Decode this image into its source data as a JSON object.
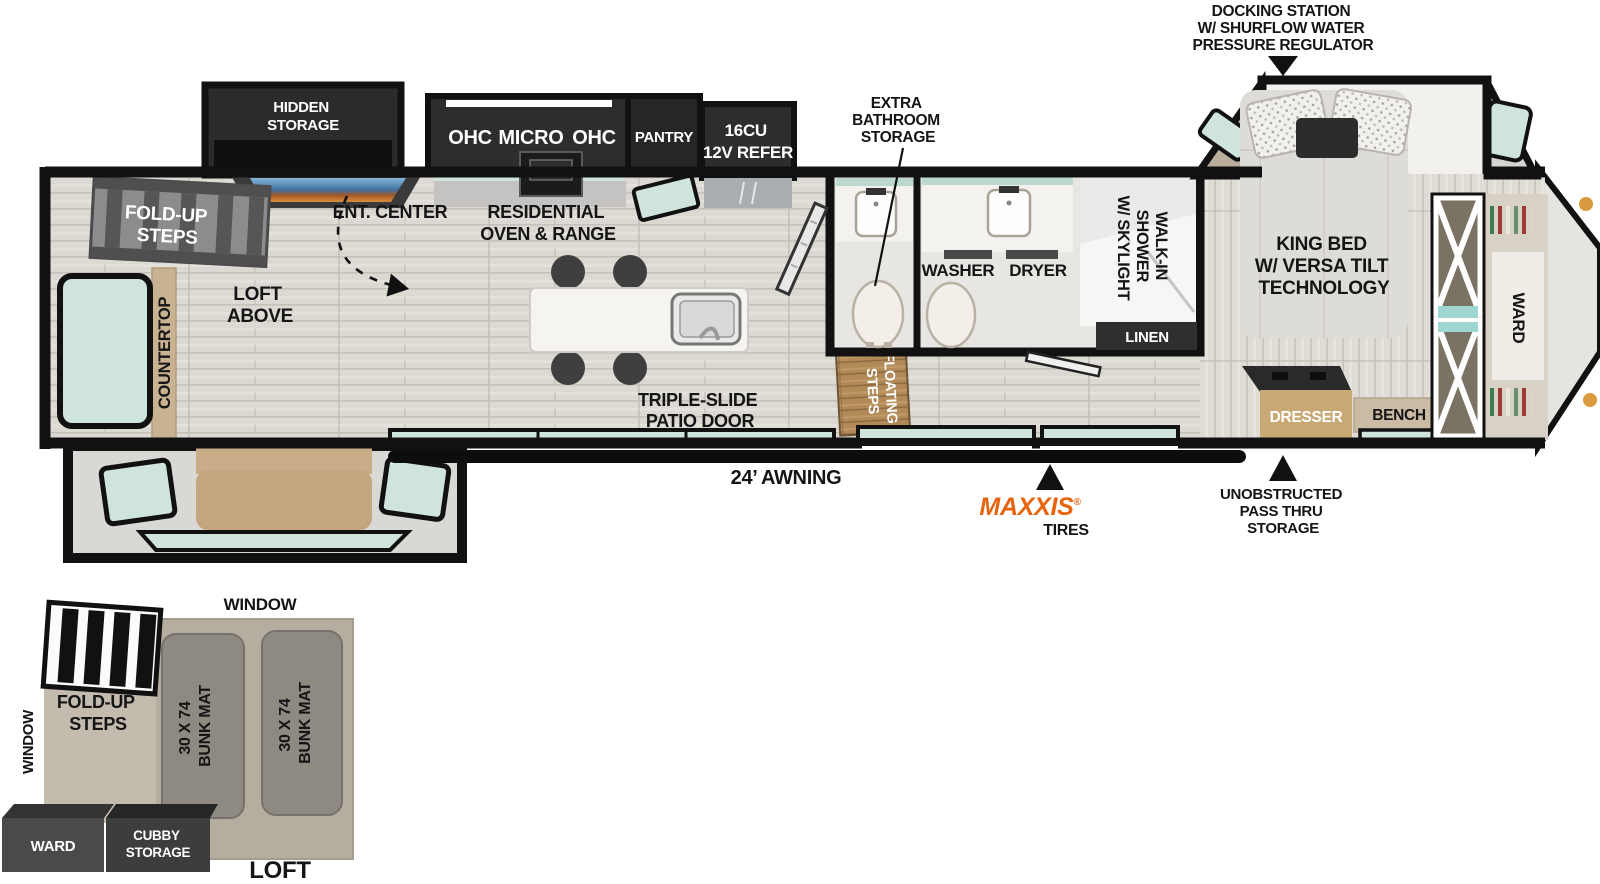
{
  "ann": {
    "dock": {
      "l1": "DOCKING STATION",
      "l2": "W/ SHURFLOW WATER",
      "l3": "PRESSURE REGULATOR"
    },
    "bath_storage": {
      "l1": "EXTRA",
      "l2": "BATHROOM",
      "l3": "STORAGE"
    },
    "awning": "24’ AWNING",
    "maxxis": {
      "brand": "MAXXIS",
      "reg": "®",
      "sub": "TIRES"
    },
    "passthru": {
      "l1": "UNOBSTRUCTED",
      "l2": "PASS THRU",
      "l3": "STORAGE"
    }
  },
  "mf": {
    "hidden": {
      "l1": "HIDDEN",
      "l2": "STORAGE"
    },
    "folds": {
      "l1": "FOLD-UP",
      "l2": "STEPS"
    },
    "ent": "ENT. CENTER",
    "loftabove": {
      "l1": "LOFT",
      "l2": "ABOVE"
    },
    "countertop": "COUNTERTOP",
    "ohc1": "OHC",
    "micro": "MICRO",
    "ohc2": "OHC",
    "pantry": "PANTRY",
    "refer": {
      "l1": "16CU",
      "l2": "12V REFER"
    },
    "resid": {
      "l1": "RESIDENTIAL",
      "l2": "OVEN & RANGE"
    },
    "patio": {
      "l1": "TRIPLE-SLIDE",
      "l2": "PATIO DOOR"
    },
    "fsteps": {
      "l1": "FLOATING",
      "l2": "STEPS"
    },
    "washer": "WASHER",
    "dryer": "DRYER",
    "shower": {
      "l1": "WALK-IN",
      "l2": "SHOWER",
      "l3": "W/ SKYLIGHT"
    },
    "linen": "LINEN",
    "bed": {
      "l1": "KING BED",
      "l2": "W/ VERSA TILT",
      "l3": "TECHNOLOGY"
    },
    "dresser": "DRESSER",
    "bench": "BENCH",
    "ward": "WARD"
  },
  "loft": {
    "window_top": "WINDOW",
    "window_left": "WINDOW",
    "folds": {
      "l1": "FOLD-UP",
      "l2": "STEPS"
    },
    "bunk1": {
      "l1": "30 X 74",
      "l2": "BUNK MAT"
    },
    "bunk2": {
      "l1": "30 X 74",
      "l2": "BUNK MAT"
    },
    "ward": "WARD",
    "cubby": {
      "l1": "CUBBY",
      "l2": "STORAGE"
    },
    "title": "LOFT"
  },
  "colors": {
    "wall": "#111111",
    "window_tint": "#cfe4da",
    "cabinet_dark": "#2d2d2d",
    "maxxis_orange": "#e8650f",
    "wood_tan": "#c9b292"
  }
}
